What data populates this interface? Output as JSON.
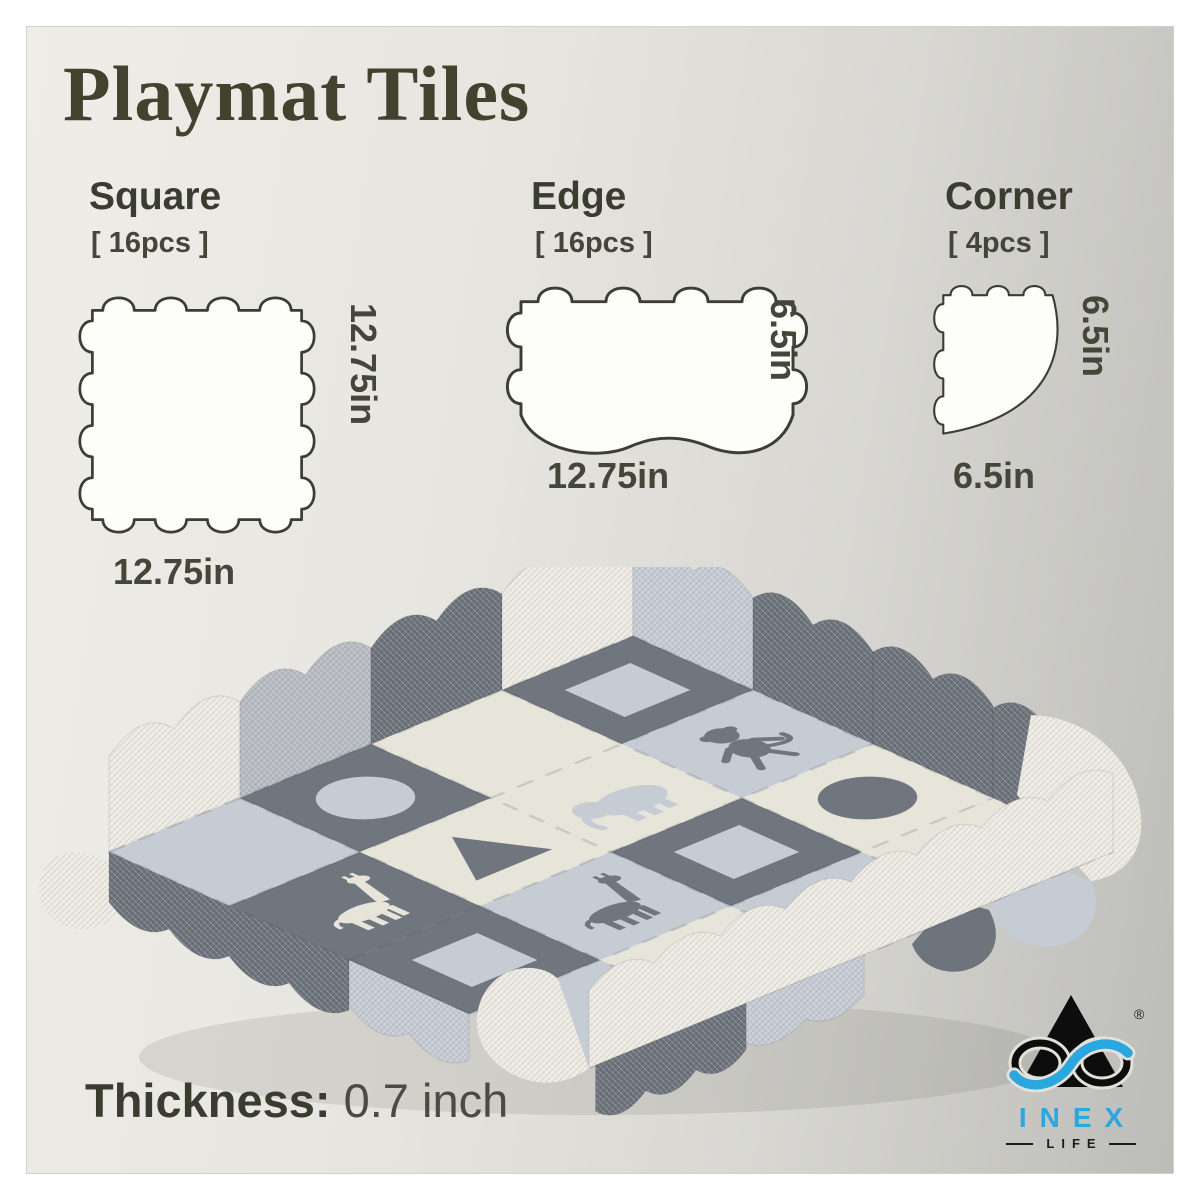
{
  "title": "Playmat Tiles",
  "sections": [
    {
      "name": "Square",
      "count": "[ 16pcs ]",
      "side_label": "12.75in",
      "bottom_label": "12.75in"
    },
    {
      "name": "Edge",
      "count": "[ 16pcs ]",
      "side_label": "6.5in",
      "bottom_label": "12.75in"
    },
    {
      "name": "Corner",
      "count": "[ 4pcs ]",
      "side_label": "6.5in",
      "bottom_label": "6.5in"
    }
  ],
  "thickness": {
    "label": "Thickness:",
    "value": "0.7 inch"
  },
  "logo": {
    "brand": "INEX",
    "sub_brand": "LIFE",
    "registered": "®",
    "accent_color": "#2BA7E0"
  },
  "colors": {
    "text_dark": "#3b3c30",
    "background_left": "#efede7",
    "background_right": "#bcbcb8",
    "tile_outline": "#3c3d33"
  },
  "playmat": {
    "palette": {
      "dark": "#70767e",
      "cream": "#e7e4da",
      "light": "#c6ccd4",
      "white": "#eceae2",
      "lightwall": "#b7bcc2",
      "walldark": "#6e747c"
    },
    "grid": [
      [
        {
          "c": "light"
        },
        {
          "c": "dark",
          "s": "circle",
          "sc": "light"
        },
        {
          "c": "cream"
        },
        {
          "c": "dark",
          "s": "square",
          "sc": "light"
        }
      ],
      [
        {
          "c": "dark",
          "s": "giraffe",
          "sc": "cream"
        },
        {
          "c": "cream",
          "s": "triangle",
          "sc": "dark"
        },
        {
          "c": "cream",
          "s": "elephant",
          "sc": "light"
        },
        {
          "c": "light",
          "s": "monkey",
          "sc": "dark"
        }
      ],
      [
        {
          "c": "dark",
          "s": "square",
          "sc": "light"
        },
        {
          "c": "light",
          "s": "giraffe",
          "sc": "dark"
        },
        {
          "c": "dark",
          "s": "square",
          "sc": "light"
        },
        {
          "c": "cream",
          "s": "circle",
          "sc": "dark"
        }
      ],
      [
        {
          "c": "light"
        },
        {
          "c": "cream",
          "s": "monkey",
          "sc": "dark"
        },
        {
          "c": "light"
        },
        {
          "c": "cream"
        }
      ]
    ]
  }
}
